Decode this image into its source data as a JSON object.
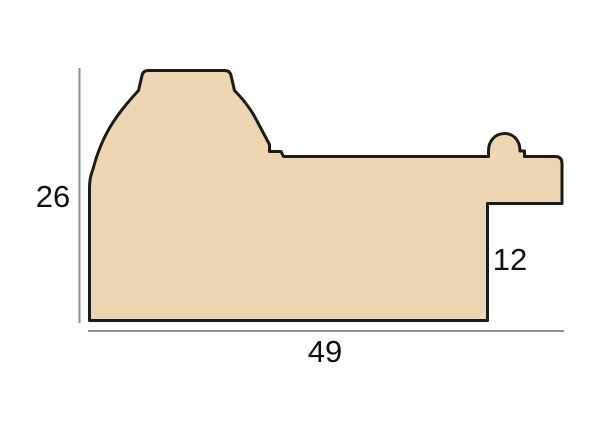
{
  "diagram": {
    "dimensions": {
      "height": {
        "value": "26"
      },
      "width": {
        "value": "49"
      },
      "rebate": {
        "value": "12"
      }
    },
    "colors": {
      "moulding_fill": "#EFD6B3",
      "outline": "#1b1b1b",
      "dimension_line": "#8f8f8f",
      "label_text": "#111111",
      "background": "#ffffff"
    }
  }
}
